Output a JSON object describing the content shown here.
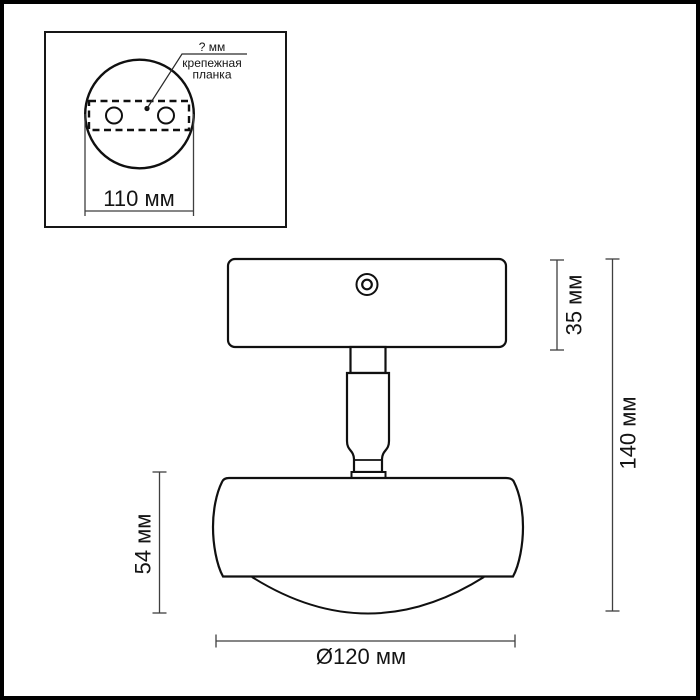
{
  "drawing": {
    "inset": {
      "hole_pitch_label": "? мм",
      "bracket_label_line1": "крепежная",
      "bracket_label_line2": "планка",
      "plate_width": "110 мм"
    },
    "dims": {
      "canopy_height": "35 мм",
      "overall_height": "140 мм",
      "head_height": "54 мм",
      "head_diameter": "Ø120 мм"
    },
    "colors": {
      "outline": "#101010",
      "dimension_line": "#3f3f3f",
      "frame": "#000000",
      "background": "#ffffff"
    }
  }
}
